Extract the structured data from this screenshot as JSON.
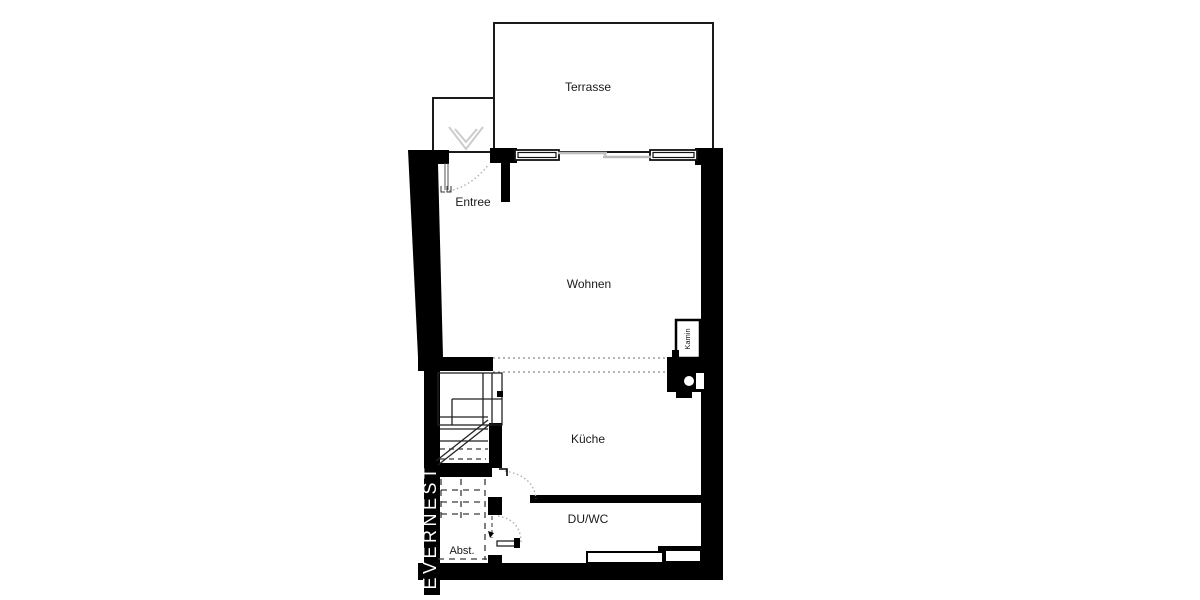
{
  "plan": {
    "brand": "EVERNEST",
    "rooms": [
      {
        "id": "terrasse",
        "label": "Terrasse"
      },
      {
        "id": "entree",
        "label": "Entree"
      },
      {
        "id": "wohnen",
        "label": "Wohnen"
      },
      {
        "id": "kamin",
        "label": "Kamin"
      },
      {
        "id": "kueche",
        "label": "Küche"
      },
      {
        "id": "duwc",
        "label": "DU/WC"
      },
      {
        "id": "abst",
        "label": "Abst."
      }
    ],
    "colors": {
      "wall": "#000000",
      "outline": "#1a1a1a",
      "dotted_opening": "#8a8a8a",
      "door_swing": "#b0b0b0",
      "light_gray": "#cccccc",
      "background": "#ffffff",
      "brand_text": "#ffffff"
    }
  }
}
